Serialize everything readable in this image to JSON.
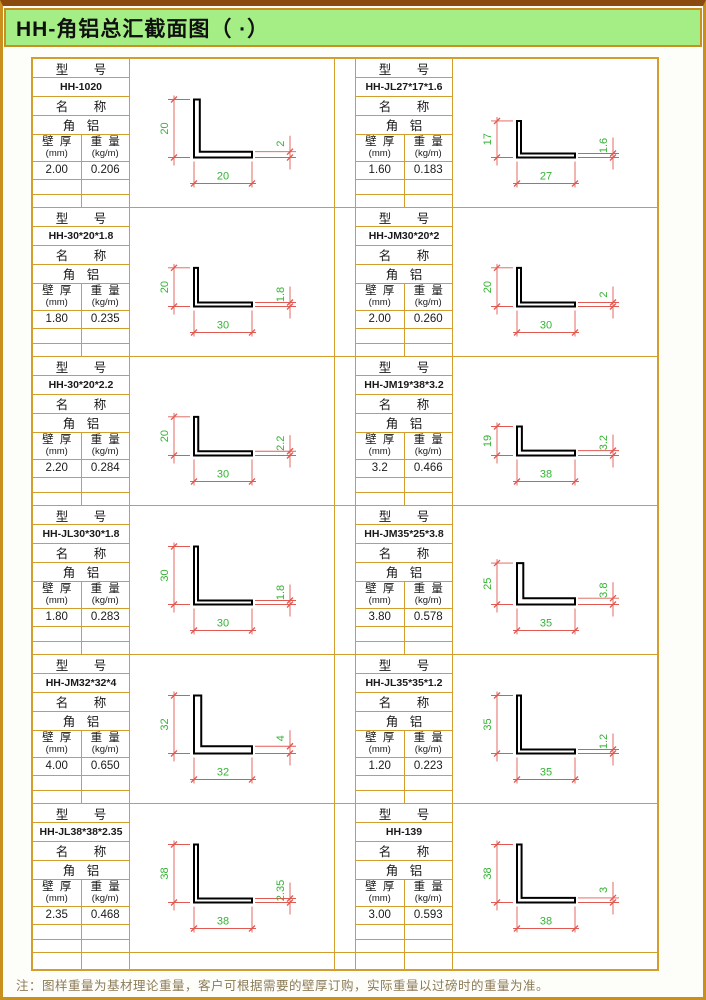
{
  "page": {
    "title": "HH-角铝总汇截面图（ ·）",
    "note": "注：图样重量为基材理论重量，客户可根据需要的壁厚订购，实际重量以过磅时的重量为准。"
  },
  "labels": {
    "model_header": "型 号",
    "name_header": "名 称",
    "product_name": "角 铝",
    "thickness_label": "壁 厚",
    "thickness_unit": "(mm)",
    "weight_label": "重 量",
    "weight_unit": "(kg/m)"
  },
  "colors": {
    "border_orange": "#d39e2d",
    "outer_border": "#c9901f",
    "title_green_bg": "#a5ee85",
    "dim_line_red": "#e05a52",
    "dim_text_green": "#35b335",
    "profile_outline": "#000000",
    "note_brown": "#8d7c58"
  },
  "chart_data": {
    "type": "table",
    "title": "HH-角铝总汇截面图（ ·）",
    "columns": [
      "型号",
      "壁厚(mm)",
      "重量(kg/m)",
      "高",
      "宽",
      "厚"
    ],
    "rows": [
      [
        "HH-1020",
        "2.00",
        "0.206",
        20,
        20,
        2
      ],
      [
        "HH-JL27*17*1.6",
        "1.60",
        "0.183",
        17,
        27,
        1.6
      ],
      [
        "HH-30*20*1.8",
        "1.80",
        "0.235",
        20,
        30,
        1.8
      ],
      [
        "HH-JM30*20*2",
        "2.00",
        "0.260",
        20,
        30,
        2
      ],
      [
        "HH-30*20*2.2",
        "2.20",
        "0.284",
        20,
        30,
        2.2
      ],
      [
        "HH-JM19*38*3.2",
        "3.2",
        "0.466",
        19,
        38,
        3.2
      ],
      [
        "HH-JL30*30*1.8",
        "1.80",
        "0.283",
        30,
        30,
        1.8
      ],
      [
        "HH-JM35*25*3.8",
        "3.80",
        "0.578",
        25,
        35,
        3.8
      ],
      [
        "HH-JM32*32*4",
        "4.00",
        "0.650",
        32,
        32,
        4
      ],
      [
        "HH-JL35*35*1.2",
        "1.20",
        "0.223",
        35,
        35,
        1.2
      ],
      [
        "HH-JL38*38*2.35",
        "2.35",
        "0.468",
        38,
        38,
        2.35
      ],
      [
        "HH-139",
        "3.00",
        "0.593",
        38,
        38,
        3
      ]
    ]
  },
  "cells": [
    {
      "model": "HH-1020",
      "wall_thickness": "2.00",
      "weight": "0.206",
      "dim_v": "20",
      "dim_h": "20",
      "dim_t": "2"
    },
    {
      "model": "HH-JL27*17*1.6",
      "wall_thickness": "1.60",
      "weight": "0.183",
      "dim_v": "17",
      "dim_h": "27",
      "dim_t": "1.6"
    },
    {
      "model": "HH-30*20*1.8",
      "wall_thickness": "1.80",
      "weight": "0.235",
      "dim_v": "20",
      "dim_h": "30",
      "dim_t": "1.8"
    },
    {
      "model": "HH-JM30*20*2",
      "wall_thickness": "2.00",
      "weight": "0.260",
      "dim_v": "20",
      "dim_h": "30",
      "dim_t": "2"
    },
    {
      "model": "HH-30*20*2.2",
      "wall_thickness": "2.20",
      "weight": "0.284",
      "dim_v": "20",
      "dim_h": "30",
      "dim_t": "2.2"
    },
    {
      "model": "HH-JM19*38*3.2",
      "wall_thickness": "3.2",
      "weight": "0.466",
      "dim_v": "19",
      "dim_h": "38",
      "dim_t": "3.2"
    },
    {
      "model": "HH-JL30*30*1.8",
      "wall_thickness": "1.80",
      "weight": "0.283",
      "dim_v": "30",
      "dim_h": "30",
      "dim_t": "1.8"
    },
    {
      "model": "HH-JM35*25*3.8",
      "wall_thickness": "3.80",
      "weight": "0.578",
      "dim_v": "25",
      "dim_h": "35",
      "dim_t": "3.8"
    },
    {
      "model": "HH-JM32*32*4",
      "wall_thickness": "4.00",
      "weight": "0.650",
      "dim_v": "32",
      "dim_h": "32",
      "dim_t": "4"
    },
    {
      "model": "HH-JL35*35*1.2",
      "wall_thickness": "1.20",
      "weight": "0.223",
      "dim_v": "35",
      "dim_h": "35",
      "dim_t": "1.2"
    },
    {
      "model": "HH-JL38*38*2.35",
      "wall_thickness": "2.35",
      "weight": "0.468",
      "dim_v": "38",
      "dim_h": "38",
      "dim_t": "2.35"
    },
    {
      "model": "HH-139",
      "wall_thickness": "3.00",
      "weight": "0.593",
      "dim_v": "38",
      "dim_h": "38",
      "dim_t": "3"
    }
  ]
}
